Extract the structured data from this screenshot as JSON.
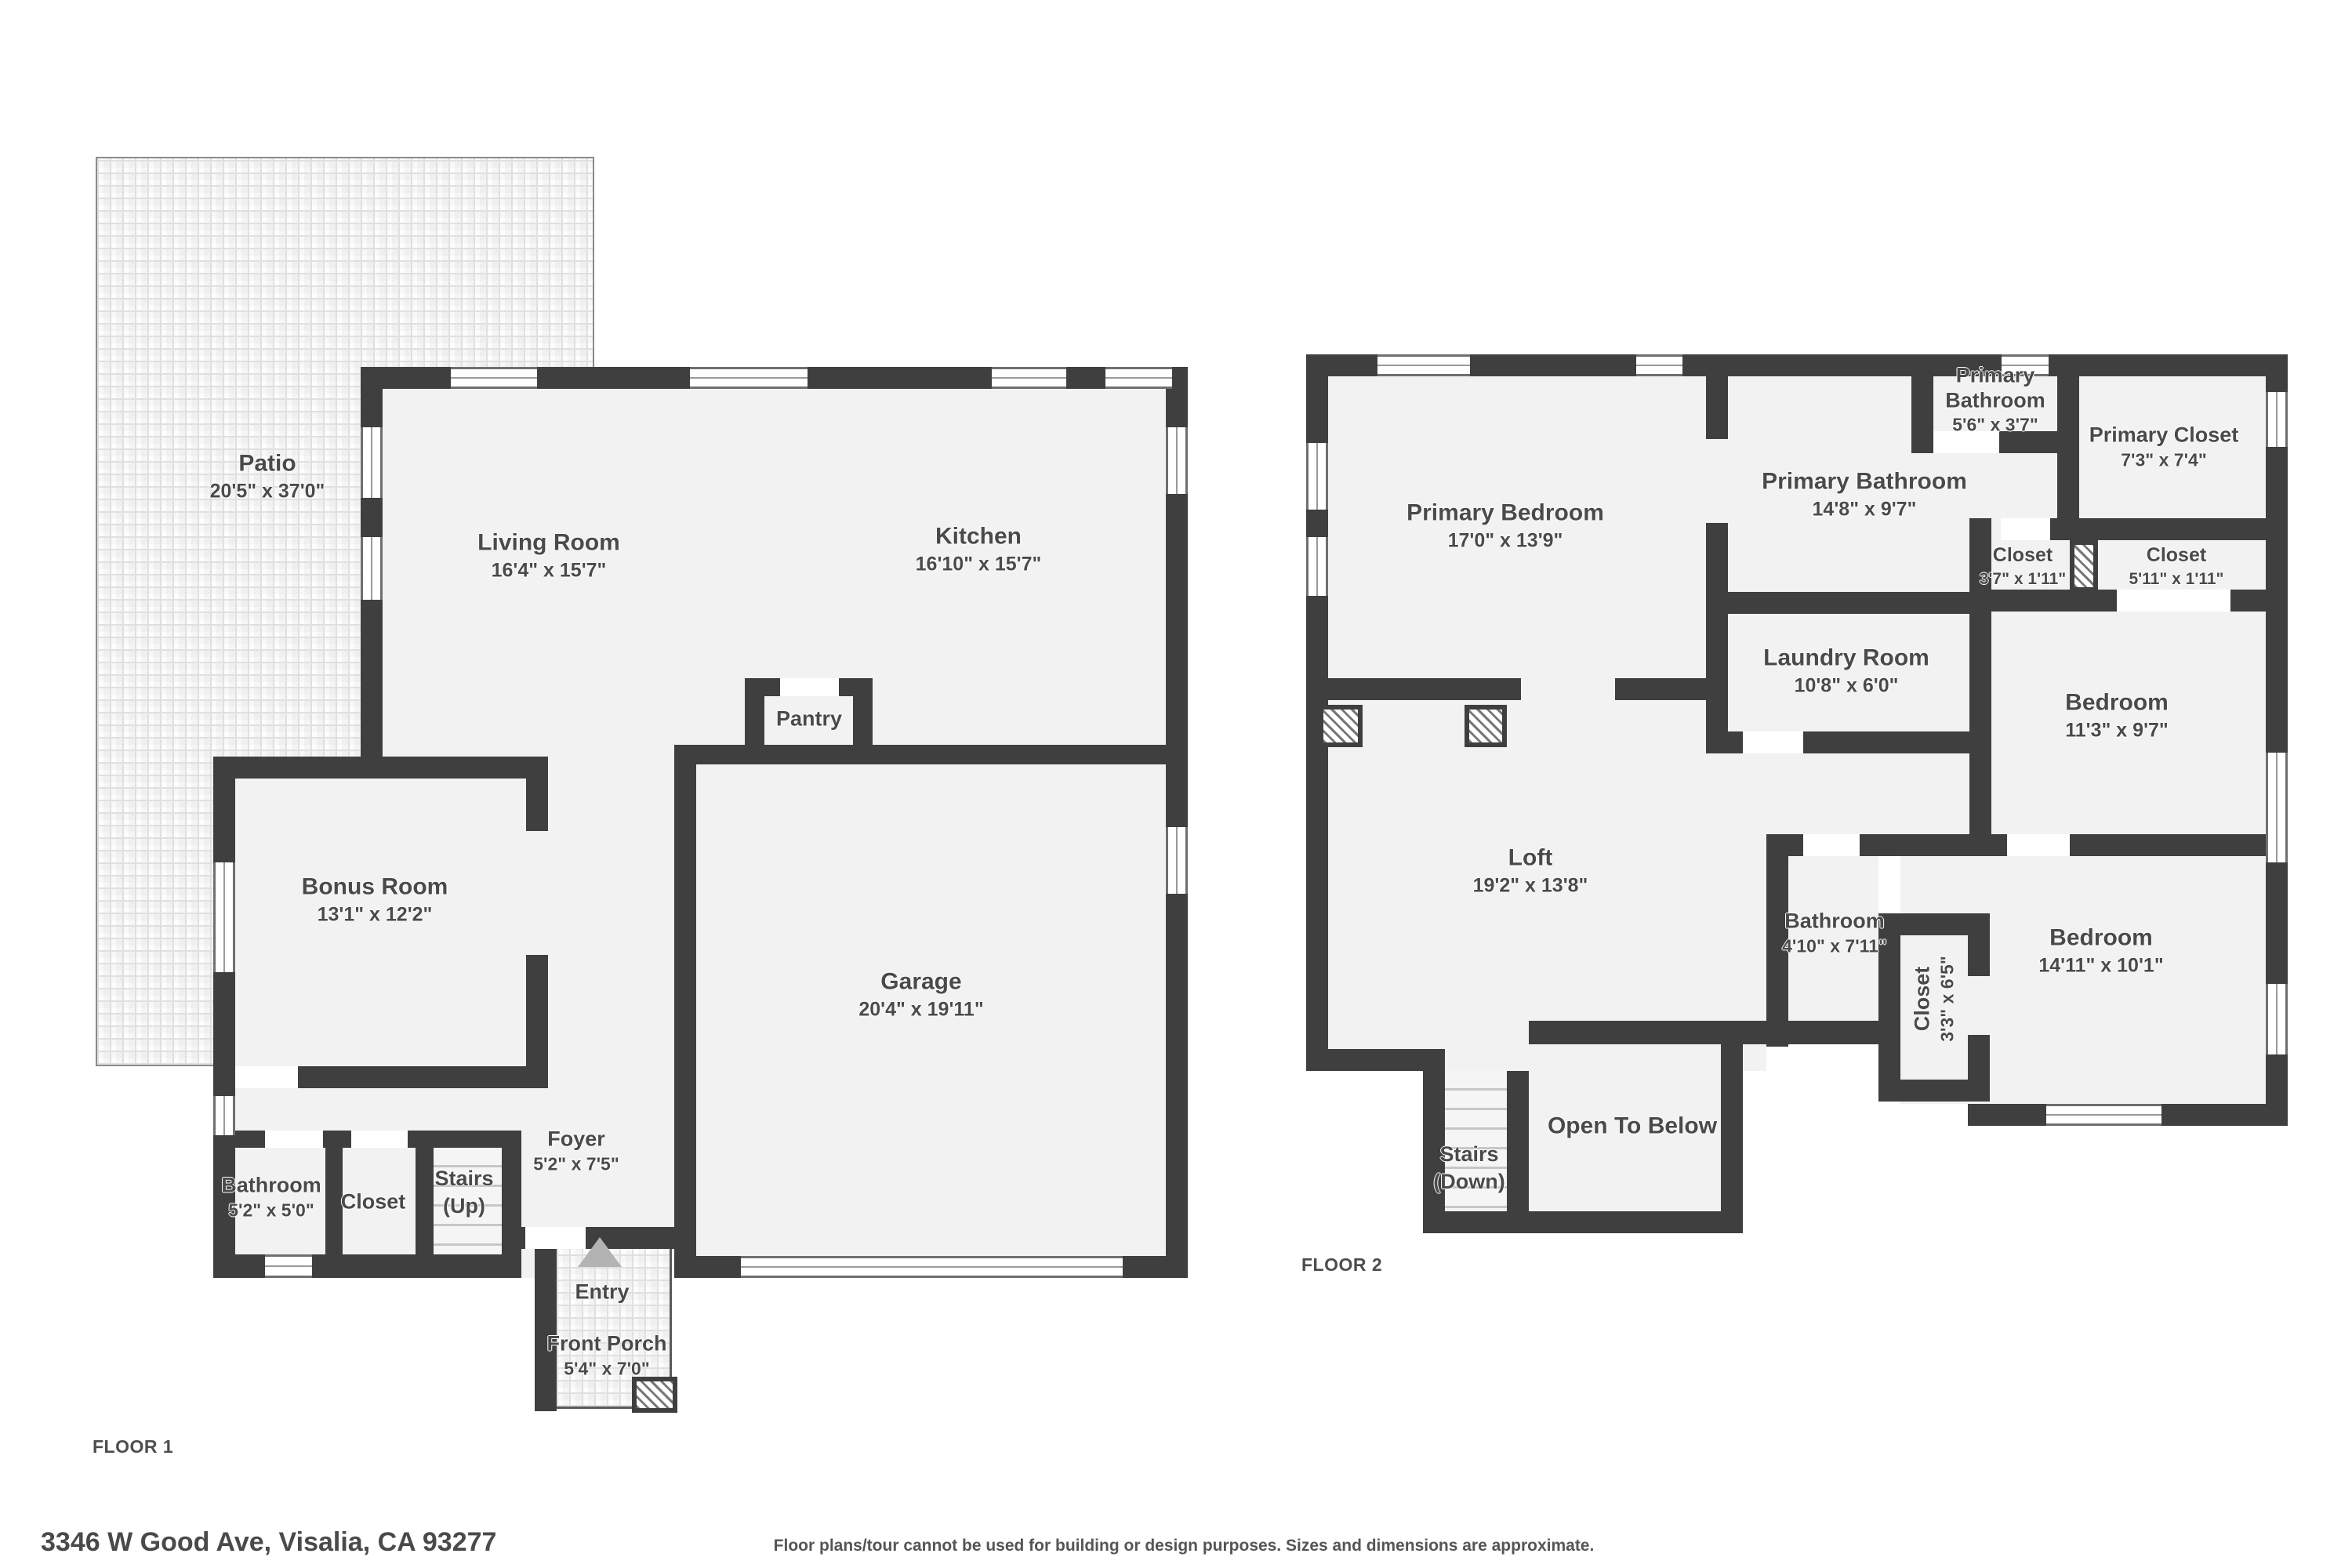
{
  "floor1": {
    "label": "FLOOR 1",
    "rooms": {
      "patio": {
        "name": "Patio",
        "dims": "20'5\" x 37'0\""
      },
      "living_room": {
        "name": "Living Room",
        "dims": "16'4\" x 15'7\""
      },
      "kitchen": {
        "name": "Kitchen",
        "dims": "16'10\" x 15'7\""
      },
      "pantry": {
        "name": "Pantry"
      },
      "bonus_room": {
        "name": "Bonus Room",
        "dims": "13'1\" x 12'2\""
      },
      "garage": {
        "name": "Garage",
        "dims": "20'4\" x 19'11\""
      },
      "bathroom": {
        "name": "Bathroom",
        "dims": "5'2\" x 5'0\""
      },
      "closet": {
        "name": "Closet"
      },
      "stairs": {
        "name": "Stairs",
        "dims": "(Up)"
      },
      "foyer": {
        "name": "Foyer",
        "dims": "5'2\" x 7'5\""
      },
      "entry": {
        "name": "Entry"
      },
      "front_porch": {
        "name": "Front Porch",
        "dims": "5'4\" x 7'0\""
      }
    }
  },
  "floor2": {
    "label": "FLOOR 2",
    "rooms": {
      "primary_bedroom": {
        "name": "Primary Bedroom",
        "dims": "17'0\" x 13'9\""
      },
      "primary_bathroom_small": {
        "name": "Primary Bathroom",
        "dims": "5'6\" x 3'7\""
      },
      "primary_bathroom": {
        "name": "Primary Bathroom",
        "dims": "14'8\" x 9'7\""
      },
      "primary_closet": {
        "name": "Primary Closet",
        "dims": "7'3\" x 7'4\""
      },
      "closet_a": {
        "name": "Closet",
        "dims": "3'7\" x 1'11\""
      },
      "closet_b": {
        "name": "Closet",
        "dims": "5'11\" x 1'11\""
      },
      "laundry_room": {
        "name": "Laundry Room",
        "dims": "10'8\" x 6'0\""
      },
      "bedroom_a": {
        "name": "Bedroom",
        "dims": "11'3\" x 9'7\""
      },
      "loft": {
        "name": "Loft",
        "dims": "19'2\" x 13'8\""
      },
      "bathroom": {
        "name": "Bathroom",
        "dims": "4'10\" x 7'11\""
      },
      "closet_c": {
        "name": "Closet",
        "dims": "3'3\" x 6'5\""
      },
      "bedroom_b": {
        "name": "Bedroom",
        "dims": "14'11\" x 10'1\""
      },
      "stairs": {
        "name": "Stairs",
        "dims": "(Down)"
      },
      "open_to_below": {
        "name": "Open To Below"
      }
    }
  },
  "footer": {
    "address": "3346 W Good Ave, Visalia, CA 93277",
    "disclaimer": "Floor plans/tour cannot be used for building or design purposes. Sizes and dimensions are approximate."
  },
  "colors": {
    "wall": "#3f3f3f",
    "room_fill": "#f2f2f2",
    "open_to_below_fill": "#ececec",
    "label_text": "#4a4a4a",
    "entry_arrow": "#b3b3b3"
  }
}
